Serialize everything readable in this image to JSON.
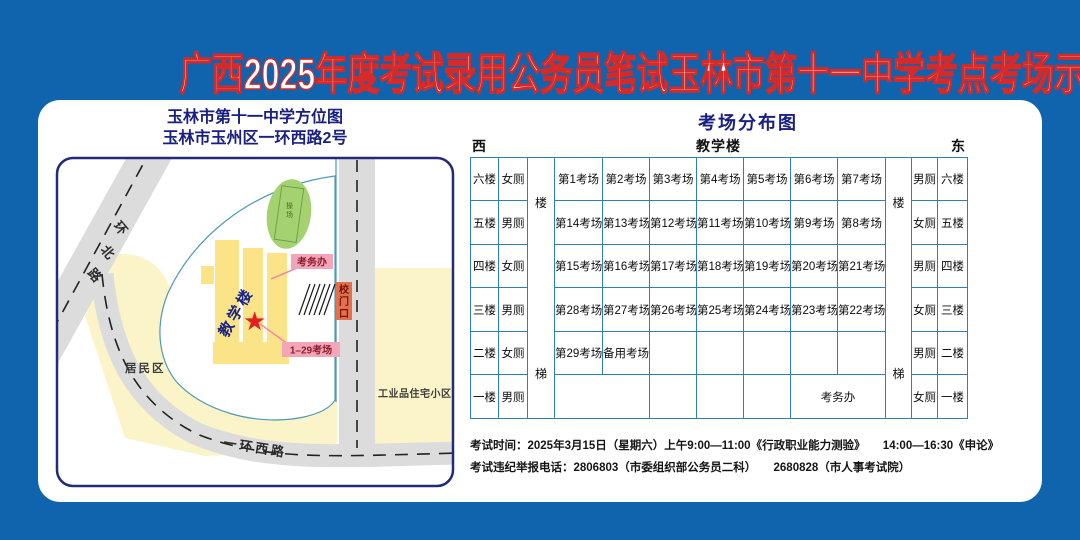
{
  "title": "广西2025年度考试录用公务员笔试玉林市第十一中学考点考场示意图",
  "map": {
    "title_line1": "玉林市第十一中学方位图",
    "title_line2": "玉林市玉州区一环西路2号",
    "labels": {
      "road_north_chars": [
        "环",
        "北",
        "路"
      ],
      "road_west": "一环西路",
      "residential": "居民区",
      "industrial": "工业品住宅小区",
      "playground_chars": [
        "操",
        "场"
      ],
      "teaching_building": "教学楼",
      "exam_office": "考务办",
      "gate_chars": [
        "校",
        "门",
        "口"
      ],
      "rooms_range": "1–29考场"
    },
    "colors": {
      "background_blue": "#1063ad",
      "title_stroke_red": "#d42a2a",
      "navy_text": "#1a2080",
      "district_yellow": "#fbf4c8",
      "building_yellow": "#fbe488",
      "playground_green": "#a6d171",
      "road_gray": "#dcdcdc",
      "pink_label": "#f2a6b8",
      "gate_orange": "#e2704c",
      "star_red": "#e41f1f",
      "table_border_blue": "#2e7fb5"
    }
  },
  "distribution": {
    "title": "考场分布图",
    "west": "西",
    "building": "教学楼",
    "east": "东",
    "stairs": [
      "楼",
      "梯"
    ],
    "rows": [
      {
        "floor_left": "六楼",
        "toilet_left": "女厕",
        "cells": [
          "第1考场",
          "第2考场",
          "第3考场",
          "第4考场",
          "第5考场",
          "第6考场",
          "第7考场"
        ],
        "toilet_right": "男厕",
        "floor_right": "六楼"
      },
      {
        "floor_left": "五楼",
        "toilet_left": "男厕",
        "cells": [
          "第14考场",
          "第13考场",
          "第12考场",
          "第11考场",
          "第10考场",
          "第9考场",
          "第8考场"
        ],
        "toilet_right": "女厕",
        "floor_right": "五楼"
      },
      {
        "floor_left": "四楼",
        "toilet_left": "女厕",
        "cells": [
          "第15考场",
          "第16考场",
          "第17考场",
          "第18考场",
          "第19考场",
          "第20考场",
          "第21考场"
        ],
        "toilet_right": "男厕",
        "floor_right": "四楼"
      },
      {
        "floor_left": "三楼",
        "toilet_left": "男厕",
        "cells": [
          "第28考场",
          "第27考场",
          "第26考场",
          "第25考场",
          "第24考场",
          "第23考场",
          "第22考场"
        ],
        "toilet_right": "女厕",
        "floor_right": "三楼"
      },
      {
        "floor_left": "二楼",
        "toilet_left": "女厕",
        "cells": [
          "第29考场",
          "备用考场",
          "",
          "",
          "",
          "",
          ""
        ],
        "toilet_right": "男厕",
        "floor_right": "二楼"
      },
      {
        "floor_left": "一楼",
        "toilet_left": "男厕",
        "office": "考务办",
        "toilet_right": "女厕",
        "floor_right": "一楼"
      }
    ]
  },
  "footer": {
    "line1": "考试时间：2025年3月15日（星期六）上午9:00—11:00《行政职业能力测验》　　14:00—16:30《申论》",
    "line2": "考试违纪举报电话：2806803（市委组织部公务员二科）　　2680828（市人事考试院）"
  }
}
